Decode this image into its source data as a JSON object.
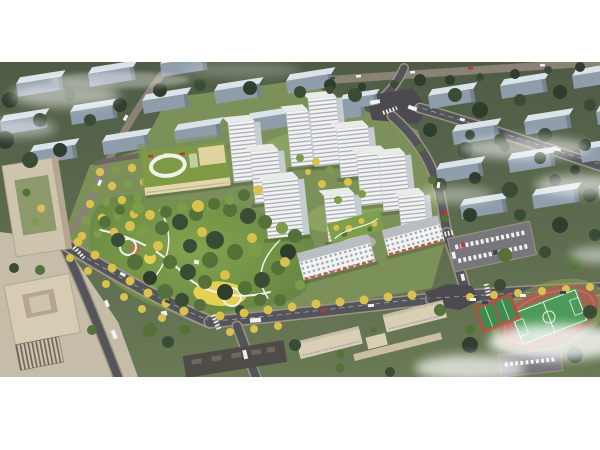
{
  "meta": {
    "title": "Aerial masterplan rendering of a residential development",
    "type": "architectural-visualization"
  },
  "scene": {
    "areas": {
      "background_city": "rows of apartment blocks among dark trees with low white mist",
      "residential_towers": "cluster of white high-rise towers around landscaped courtyards",
      "retail_slabs": "mid-rise slab buildings with street-level shops and red awnings",
      "kindergarten": "low building with green roof and white rooftop loop",
      "central_park": "dense park with winding white paths and a yellow playground",
      "office_complex": "beige office blocks with paved plaza and tree grid",
      "school_campus": "linked beige school buildings south of the avenue",
      "sports_field": "green pitch with red running track and basketball courts",
      "avenues": "tree-lined boulevards with cars and buses"
    }
  },
  "palette": {
    "canvas": "#ffffff",
    "terrainTop": "#4f5b46",
    "terrainBottom": "#697a55",
    "parkDeep": "#5d7d3e",
    "parkLight": "#84a44e",
    "bgBldgRoof": "#dbe3ea",
    "bgBldgFace": "#8f9dab",
    "bgBldgEdge": "#76838f",
    "bgRoad": "#8a8375",
    "treeDark": "#2f3d2d",
    "treeDeep": "#3b4c36",
    "treeGreen": "#557039",
    "treeLight": "#7d9c4a",
    "treeYellow": "#d8c14e",
    "treeOlive": "#98a855",
    "devGround": "#7c905a",
    "innerCourt": "#8ca262",
    "pavement": "#b6b0a2",
    "pathWhite": "#f1f1e8",
    "playYellow": "#e4d052",
    "playOrange": "#b5764c",
    "towerFace": "#f3f4f2",
    "towerSide": "#c7ccd1",
    "towerRoof": "#e9ebe9",
    "towerWin": "#99a2ad",
    "slabRoof": "#b9bec2",
    "awning": "#c4543e",
    "podiumGreen": "#7fa04b",
    "kRoof": "#7e9a45",
    "kWall": "#e5d7a5",
    "kTrim": "#f2f2ea",
    "officeWall": "#cfc4ad",
    "officeRoof": "#d6ccb4",
    "officeInner": "#b3a88f",
    "officeCourt": "#8d9a6b",
    "officeFacadeDark": "#6f6757",
    "plaza": "#c6bda9",
    "road": "#54555a",
    "roadMinor": "#6b675f",
    "sidewalk": "#9d9484",
    "junction": "#4c4a4e",
    "schoolWall": "#d9cfb5",
    "schoolRoof": "#c9bfa4",
    "darkRoof": "#4f4b46",
    "darkRoofUnit": "#6e6860",
    "fieldGreen": "#4c9a58",
    "trackRed": "#a86050",
    "trackLane": "#bd8472",
    "courtRed": "#b44f42",
    "courtGreen": "#3f8a4f",
    "lineWhite": "#e9efe6",
    "parking": "#77777b",
    "carWhite": "#eef0f2",
    "carRed": "#b23a30",
    "carDark": "#3f454d",
    "mist": "#ffffff"
  }
}
